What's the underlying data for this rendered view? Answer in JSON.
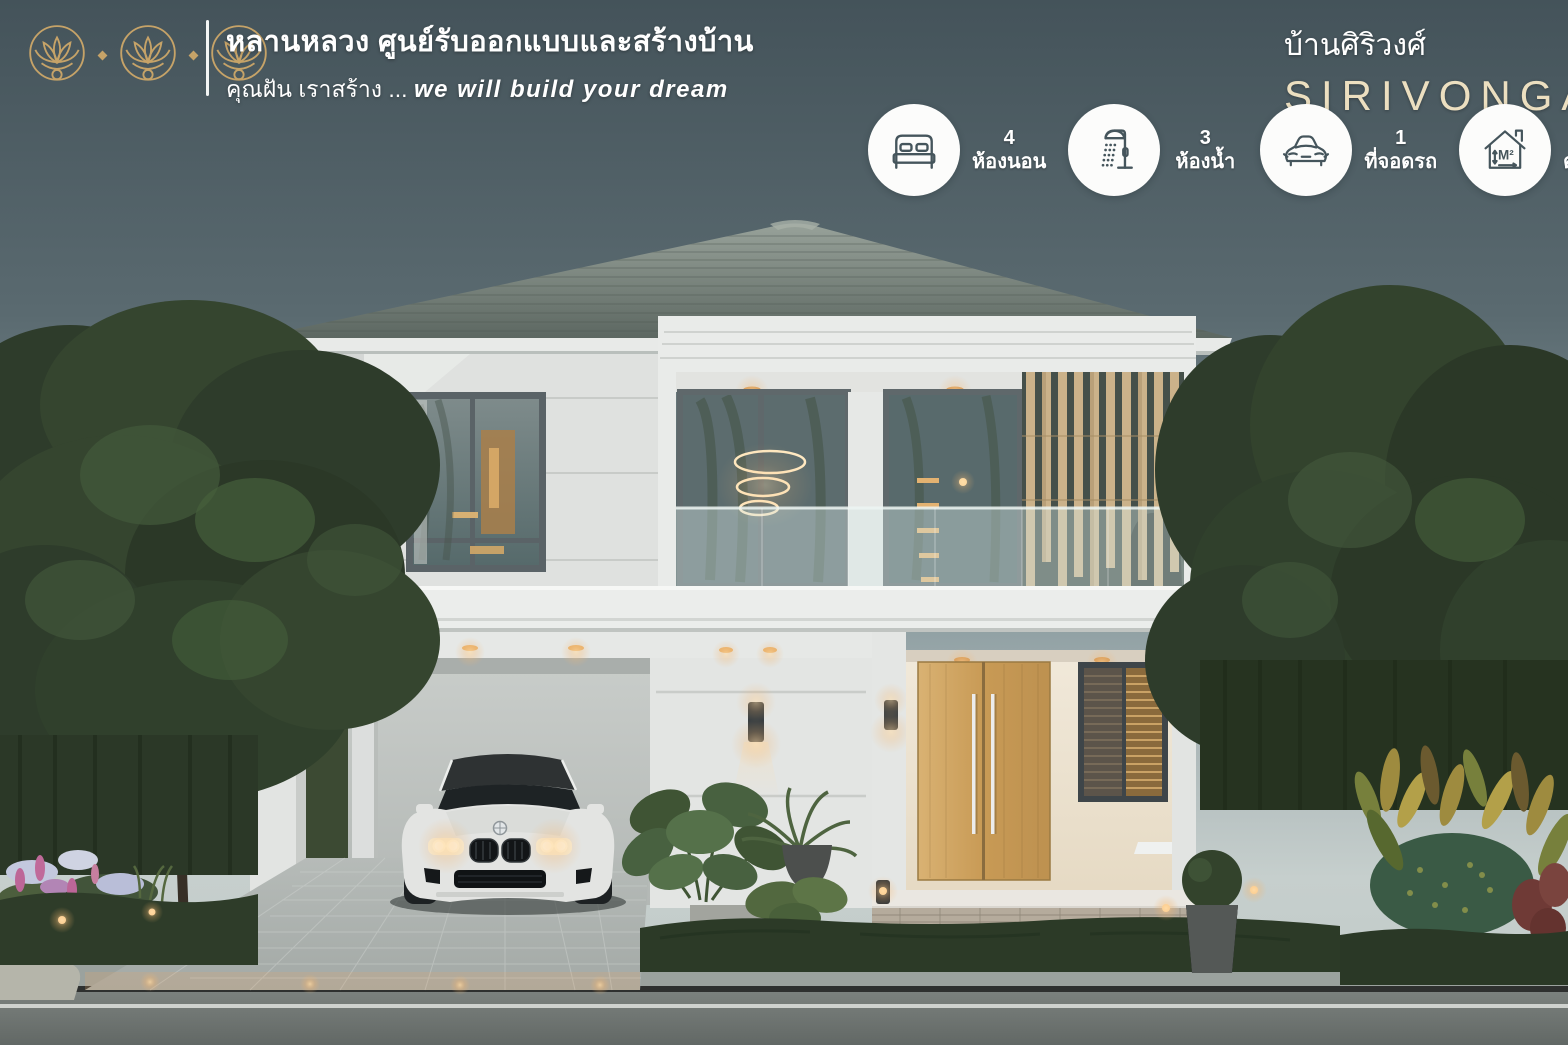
{
  "header": {
    "logo_name": "triple-lotus-logo",
    "company_line1": "หลานหลวง ศูนย์รับออกแบบและสร้างบ้าน",
    "slogan_th": "คุณฝัน เราสร้าง ...",
    "slogan_en": "we will build your dream"
  },
  "project": {
    "name_th": "บ้านศิริวงศ์",
    "name_en": "SIRIVONGA"
  },
  "features": [
    {
      "icon": "bed-icon",
      "value": "4",
      "label": "ห้องนอน"
    },
    {
      "icon": "shower-icon",
      "value": "3",
      "label": "ห้องน้ำ"
    },
    {
      "icon": "car-icon",
      "value": "1",
      "label": "ที่จอดรถ"
    },
    {
      "icon": "area-icon",
      "value": "175",
      "label": "ตารางเมตร",
      "unit_mark": "M²"
    }
  ],
  "colors": {
    "sky_top": "#44535a",
    "sky_horizon": "#c6cfcd",
    "accent_gold": "#c6a368",
    "brand_cream": "#ecdfc0",
    "icon_stroke": "#45555c",
    "roof": "#66716a",
    "wall_white": "#e6e8e6",
    "wood_door": "#c9a05e",
    "warm_light": "#ffd9a3"
  }
}
